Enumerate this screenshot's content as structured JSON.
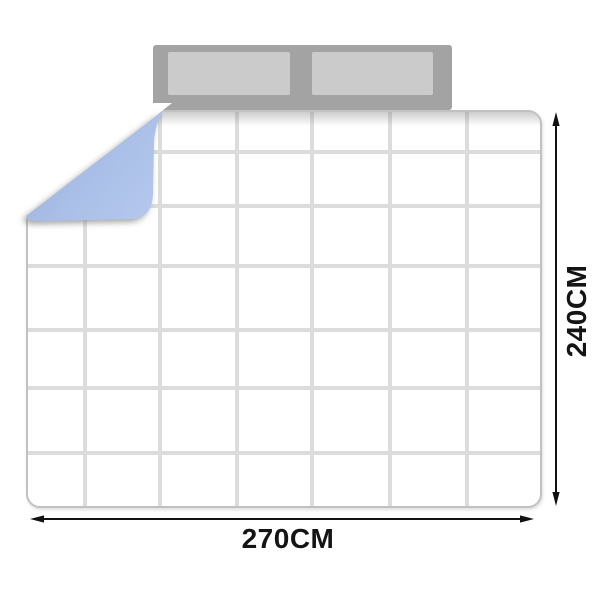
{
  "diagram": {
    "type": "bedding-size-diagram",
    "width_label": "270CM",
    "height_label": "240CM",
    "quilt": {
      "grid_columns": 7,
      "grid_rows": 7
    },
    "colors": {
      "quilt_top": "#ffffff",
      "quilt_grid_line": "#dcdcdc",
      "quilt_border": "#c1c1c1",
      "fold_underside_blue": "#aabfe7",
      "headboard_gray": "#a3a3a3",
      "pillow_gray": "#cbcbcb",
      "dimension_line_black": "#111111"
    }
  }
}
